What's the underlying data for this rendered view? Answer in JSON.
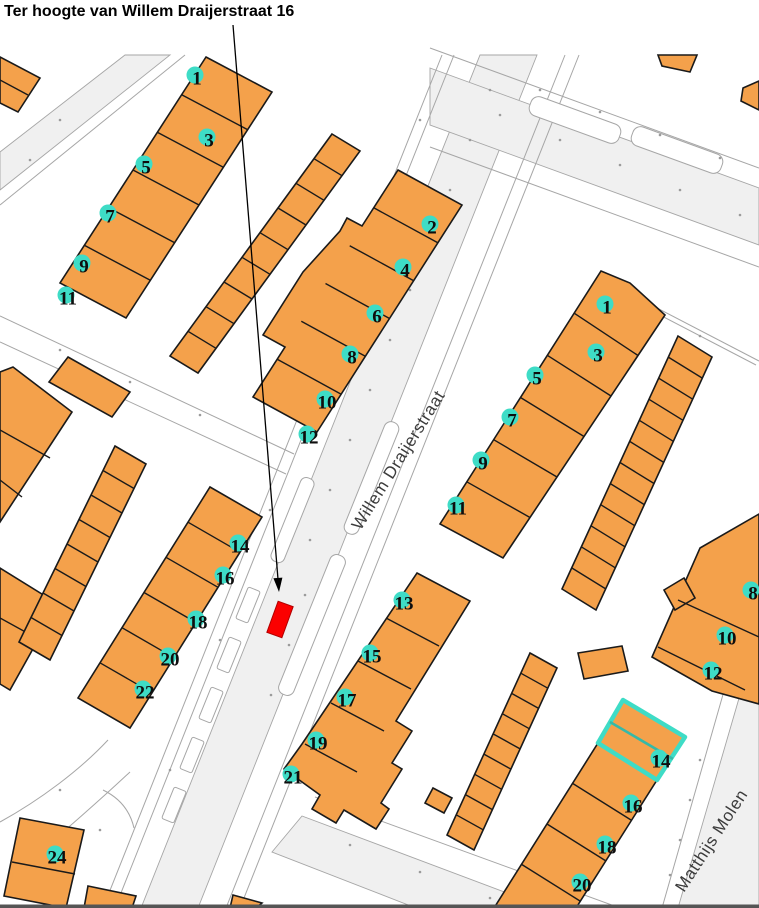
{
  "title": "Ter hoogte van Willem Draijerstraat 16",
  "map": {
    "streets": [
      {
        "name": "Willem Draijerstraat"
      },
      {
        "name": "Matthijs Molen"
      }
    ],
    "house_numbers": [
      {
        "n": "1",
        "x": 197,
        "y": 78
      },
      {
        "n": "3",
        "x": 209,
        "y": 140
      },
      {
        "n": "5",
        "x": 146,
        "y": 167
      },
      {
        "n": "7",
        "x": 110,
        "y": 216
      },
      {
        "n": "9",
        "x": 84,
        "y": 266
      },
      {
        "n": "11",
        "x": 68,
        "y": 298
      },
      {
        "n": "2",
        "x": 432,
        "y": 227
      },
      {
        "n": "4",
        "x": 405,
        "y": 270
      },
      {
        "n": "6",
        "x": 377,
        "y": 316
      },
      {
        "n": "8",
        "x": 352,
        "y": 357
      },
      {
        "n": "10",
        "x": 327,
        "y": 402
      },
      {
        "n": "12",
        "x": 309,
        "y": 437
      },
      {
        "n": "1",
        "x": 607,
        "y": 307
      },
      {
        "n": "3",
        "x": 598,
        "y": 355
      },
      {
        "n": "5",
        "x": 537,
        "y": 378
      },
      {
        "n": "7",
        "x": 512,
        "y": 420
      },
      {
        "n": "9",
        "x": 483,
        "y": 463
      },
      {
        "n": "11",
        "x": 458,
        "y": 508
      },
      {
        "n": "8",
        "x": 753,
        "y": 593
      },
      {
        "n": "10",
        "x": 727,
        "y": 638
      },
      {
        "n": "12",
        "x": 713,
        "y": 673
      },
      {
        "n": "14",
        "x": 240,
        "y": 546
      },
      {
        "n": "16",
        "x": 225,
        "y": 578
      },
      {
        "n": "18",
        "x": 198,
        "y": 622
      },
      {
        "n": "20",
        "x": 170,
        "y": 659
      },
      {
        "n": "22",
        "x": 145,
        "y": 692
      },
      {
        "n": "13",
        "x": 404,
        "y": 603
      },
      {
        "n": "15",
        "x": 372,
        "y": 656
      },
      {
        "n": "17",
        "x": 347,
        "y": 700
      },
      {
        "n": "19",
        "x": 318,
        "y": 743
      },
      {
        "n": "21",
        "x": 293,
        "y": 777
      },
      {
        "n": "14",
        "x": 661,
        "y": 761
      },
      {
        "n": "16",
        "x": 633,
        "y": 806
      },
      {
        "n": "18",
        "x": 607,
        "y": 847
      },
      {
        "n": "20",
        "x": 582,
        "y": 885
      },
      {
        "n": "24",
        "x": 57,
        "y": 857
      }
    ],
    "highlight_marker": {
      "shape": "rectangle",
      "color": "#FB0000"
    },
    "selected_building_number": "14"
  },
  "colors": {
    "building_fill": "#F4A14B",
    "building_outline": "#1A1A1A",
    "road_fill": "#F0F0F0",
    "road_line": "#A6A6A6",
    "marker_red": "#FB0000",
    "selection_cyan": "#3EDCC6",
    "selection_divider": "#35B9A8",
    "number_marker": "#3EDCC6",
    "number_text": "#0E0E0E",
    "street_label": "#3C3C3C",
    "dot": "#9B9B9B",
    "bottom_bar": "#555555",
    "annotation": "#000000"
  }
}
